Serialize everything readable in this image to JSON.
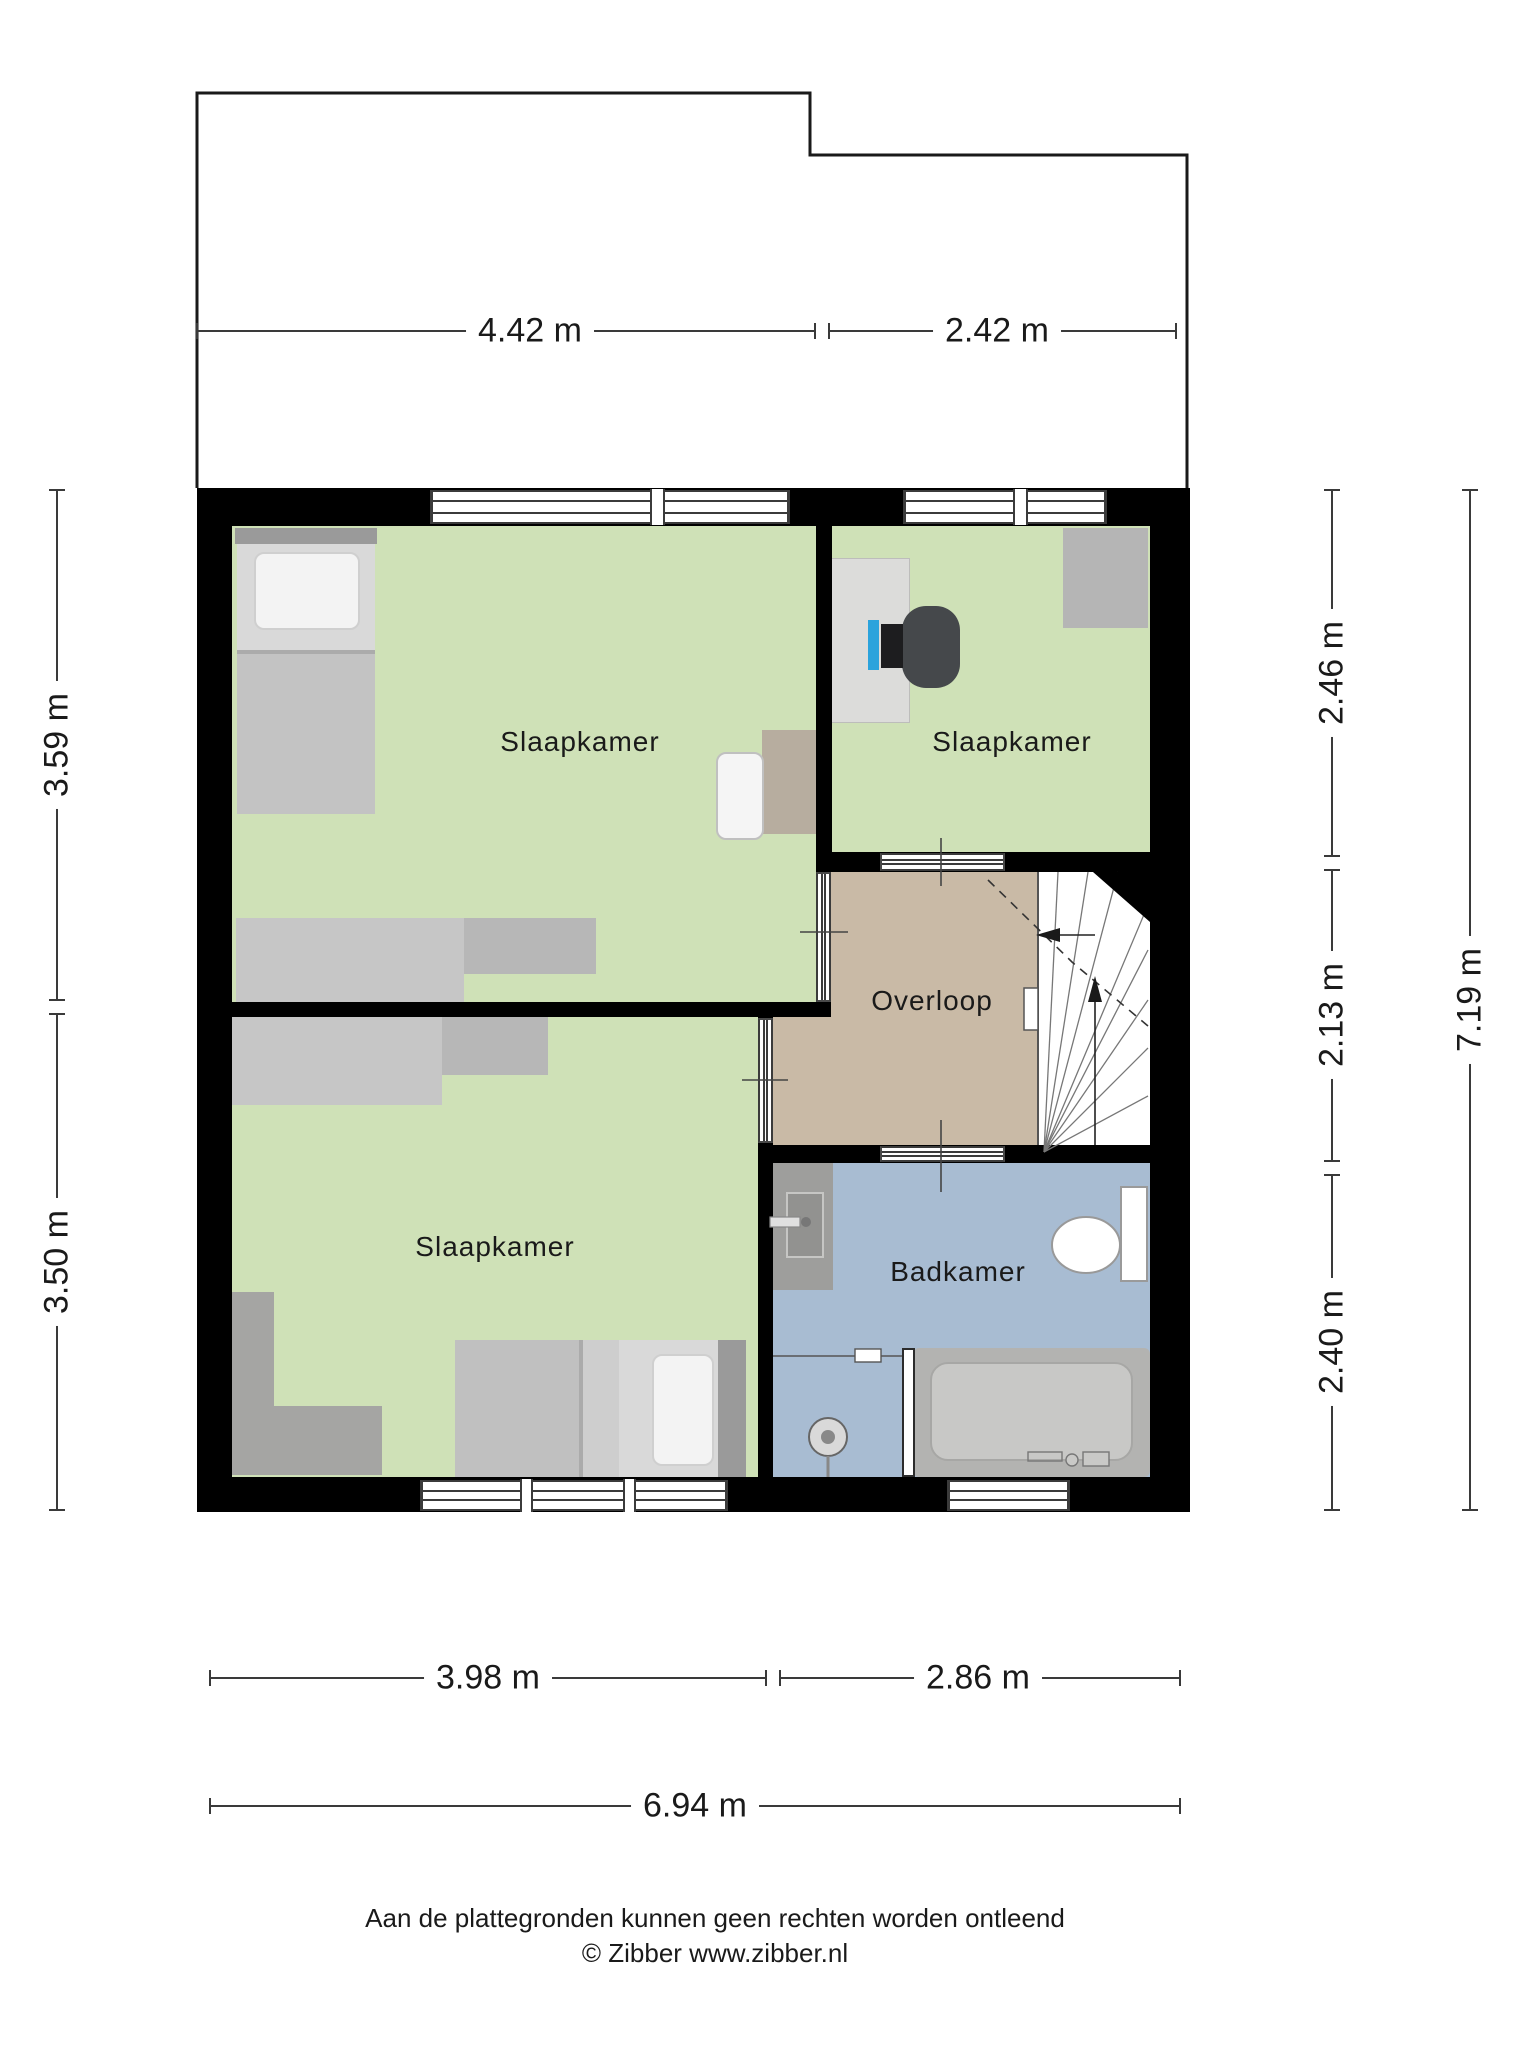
{
  "rooms": [
    {
      "id": "slaapkamer-top-left",
      "label": "Slaapkamer",
      "color": "#cfe1b7"
    },
    {
      "id": "slaapkamer-top-right",
      "label": "Slaapkamer",
      "color": "#cfe1b7"
    },
    {
      "id": "overloop",
      "label": "Overloop",
      "color": "#c9baa6"
    },
    {
      "id": "slaapkamer-bottom",
      "label": "Slaapkamer",
      "color": "#cfe1b7"
    },
    {
      "id": "badkamer",
      "label": "Badkamer",
      "color": "#a8bcd2"
    }
  ],
  "dimensions": {
    "top": [
      "4.42 m",
      "2.42 m"
    ],
    "left": [
      "3.59 m",
      "3.50 m"
    ],
    "right": [
      "2.46 m",
      "2.13 m",
      "2.40 m"
    ],
    "right_total": "7.19 m",
    "bottom": [
      "3.98 m",
      "2.86 m"
    ],
    "bottom_total": "6.94 m"
  },
  "footer": {
    "disclaimer": "Aan de plattegronden kunnen geen rechten worden ontleend",
    "credit": "© Zibber www.zibber.nl"
  },
  "colors": {
    "wall": "#000000",
    "bedroom_floor": "#cfe1b7",
    "landing_floor": "#c9baa6",
    "bathroom_floor": "#a8bcd2",
    "dimension_line": "#3a3a3a",
    "monitor_screen_accent": "#2ba3dc"
  }
}
